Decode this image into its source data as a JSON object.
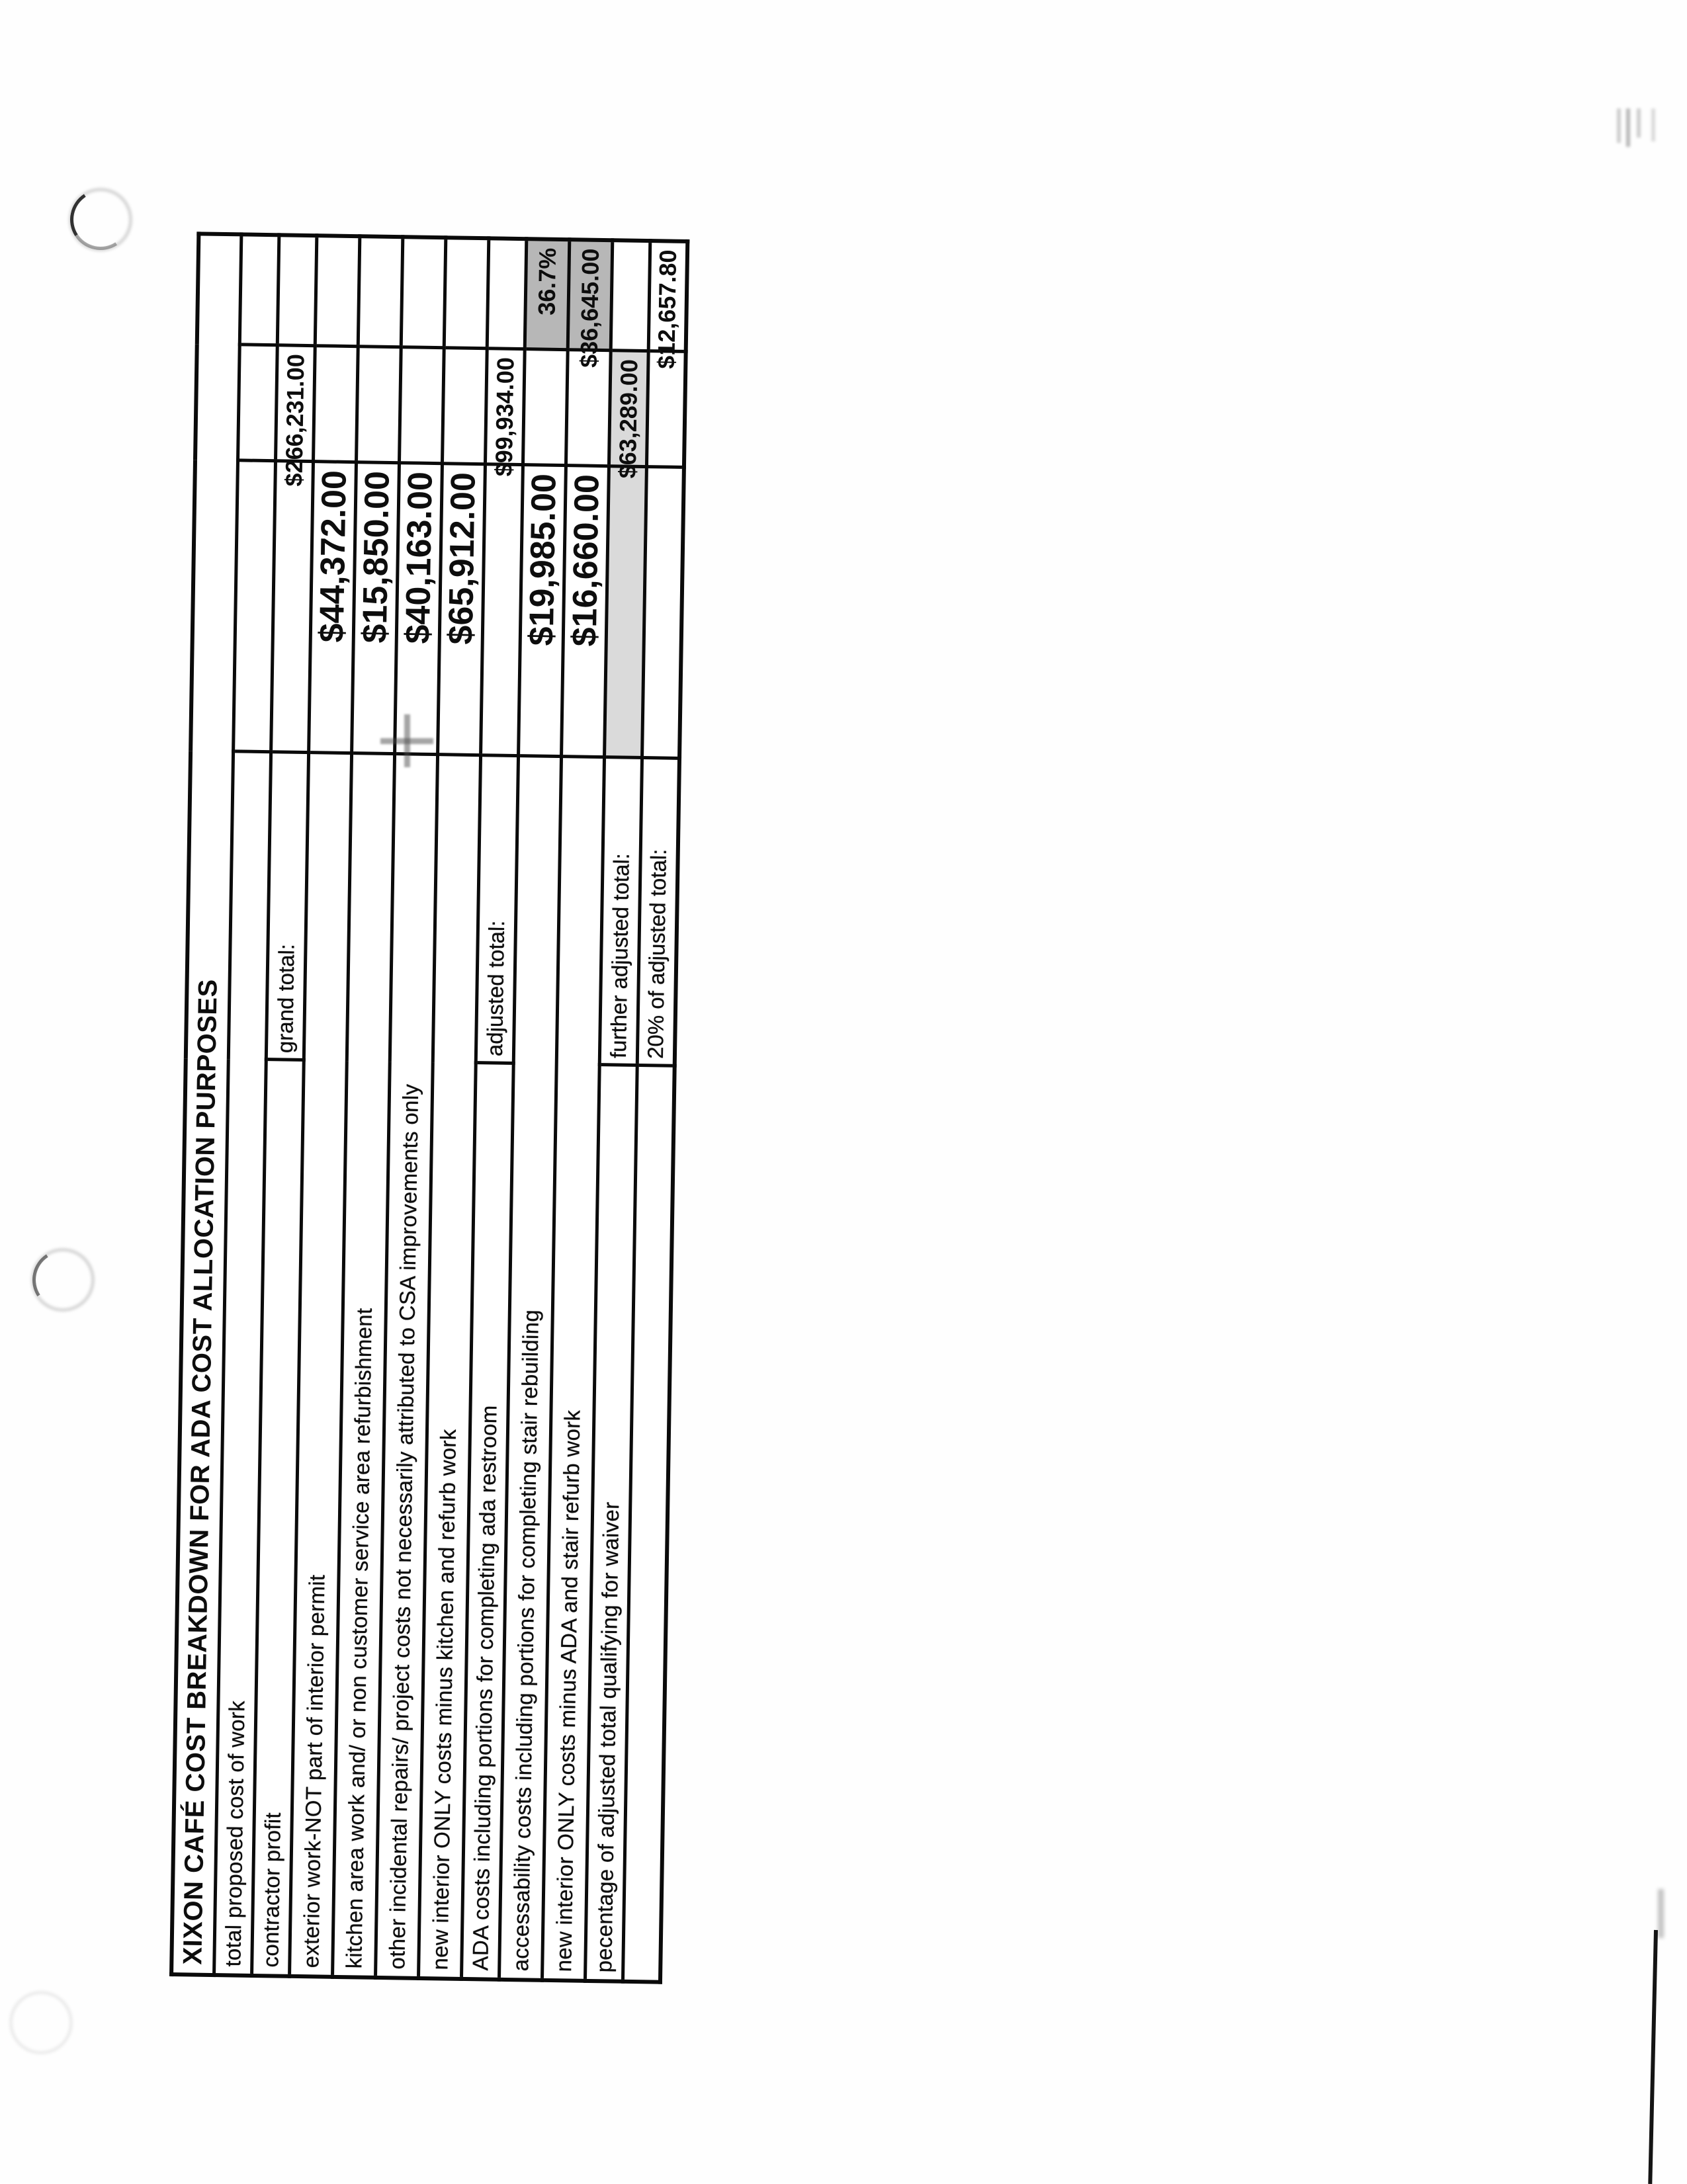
{
  "document": {
    "kind": "scanned spreadsheet printout, rotated 90 degrees on page",
    "title": "XIXON CAFÉ COST BREAKDOWN FOR ADA COST ALLOCATION PURPOSES"
  },
  "table": {
    "rows": [
      {
        "label": "total proposed cost of work",
        "sublabel": "",
        "value": "",
        "subtotal": "",
        "final": ""
      },
      {
        "label": "contractor profit",
        "sublabel": "grand total:",
        "value": "",
        "subtotal": "$266,231.00",
        "final": ""
      },
      {
        "label": "exterior work-NOT part of interior permit",
        "sublabel": "",
        "value": "$44,372.00",
        "subtotal": "",
        "final": ""
      },
      {
        "label": "kitchen area work and/ or non customer service area refurbishment",
        "sublabel": "",
        "value": "$15,850.00",
        "subtotal": "",
        "final": ""
      },
      {
        "label": "other incidental repairs/ project costs not necessarily attributed to CSA improvements only",
        "sublabel": "",
        "value": "$40,163.00",
        "subtotal": "",
        "final": ""
      },
      {
        "label": "new interior ONLY costs minus kitchen and refurb work",
        "sublabel": "",
        "value": "$65,912.00",
        "subtotal": "",
        "final": ""
      },
      {
        "label": "ADA costs including portions for completing ada restroom",
        "sublabel": "adjusted total:",
        "value": "",
        "subtotal": "$99,934.00",
        "final": ""
      },
      {
        "label": "accessability costs including portions for completing stair rebuilding",
        "sublabel": "",
        "value": "$19,985.00",
        "subtotal": "",
        "final": "36.7%"
      },
      {
        "label": "new interior ONLY costs minus ADA and stair refurb work",
        "sublabel": "",
        "value": "$16,660.00",
        "subtotal": "",
        "final": "$36,645.00"
      },
      {
        "label": "pecentage of adjusted total qualifying for waiver",
        "sublabel": "further adjusted total:",
        "value": "",
        "subtotal": "$63,289.00",
        "final": ""
      },
      {
        "label": "",
        "sublabel": "20% of adjusted total:",
        "value": "",
        "subtotal": "",
        "final": "$12,657.80"
      }
    ],
    "colors": {
      "ink": "#0d0d0d",
      "gridline": "#0a0a0a",
      "shaded_cell": "#b7b7b7",
      "shaded_subtotal_row": "#dadada",
      "paper": "#fefefe"
    }
  }
}
